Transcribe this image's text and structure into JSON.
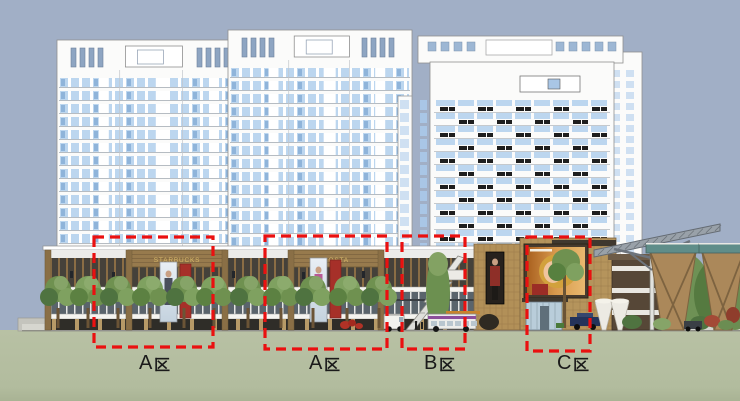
{
  "zones": [
    {
      "id": "A1",
      "label": "A区",
      "letter": "A"
    },
    {
      "id": "A2",
      "label": "A区",
      "letter": "A"
    },
    {
      "id": "B",
      "label": "B区",
      "letter": "B"
    },
    {
      "id": "C",
      "label": "C区",
      "letter": "C"
    }
  ],
  "signs": {
    "podium_sign_1": "STARBUCKS",
    "podium_sign_2": "COSTA"
  },
  "colors": {
    "sky": "#a1afc6",
    "ground": "#b6bfa2",
    "ground_dark": "#a9b394",
    "zone_outline": "#ea1010",
    "label_text": "#1a1a1a",
    "facade_white": "#fbfbfa",
    "window_blue": "#bcd6ef",
    "window_accent": "#8fb4da",
    "wood": "#977a4d",
    "wood_dark": "#7c6440",
    "glass_dark": "#45413a",
    "tile_tan": "#b29058",
    "tree_green": "#6f9150",
    "sign_gold": "#d9b96a",
    "ac_unit": "#1e1e1e",
    "billboard_warm": "#d89a4e"
  }
}
